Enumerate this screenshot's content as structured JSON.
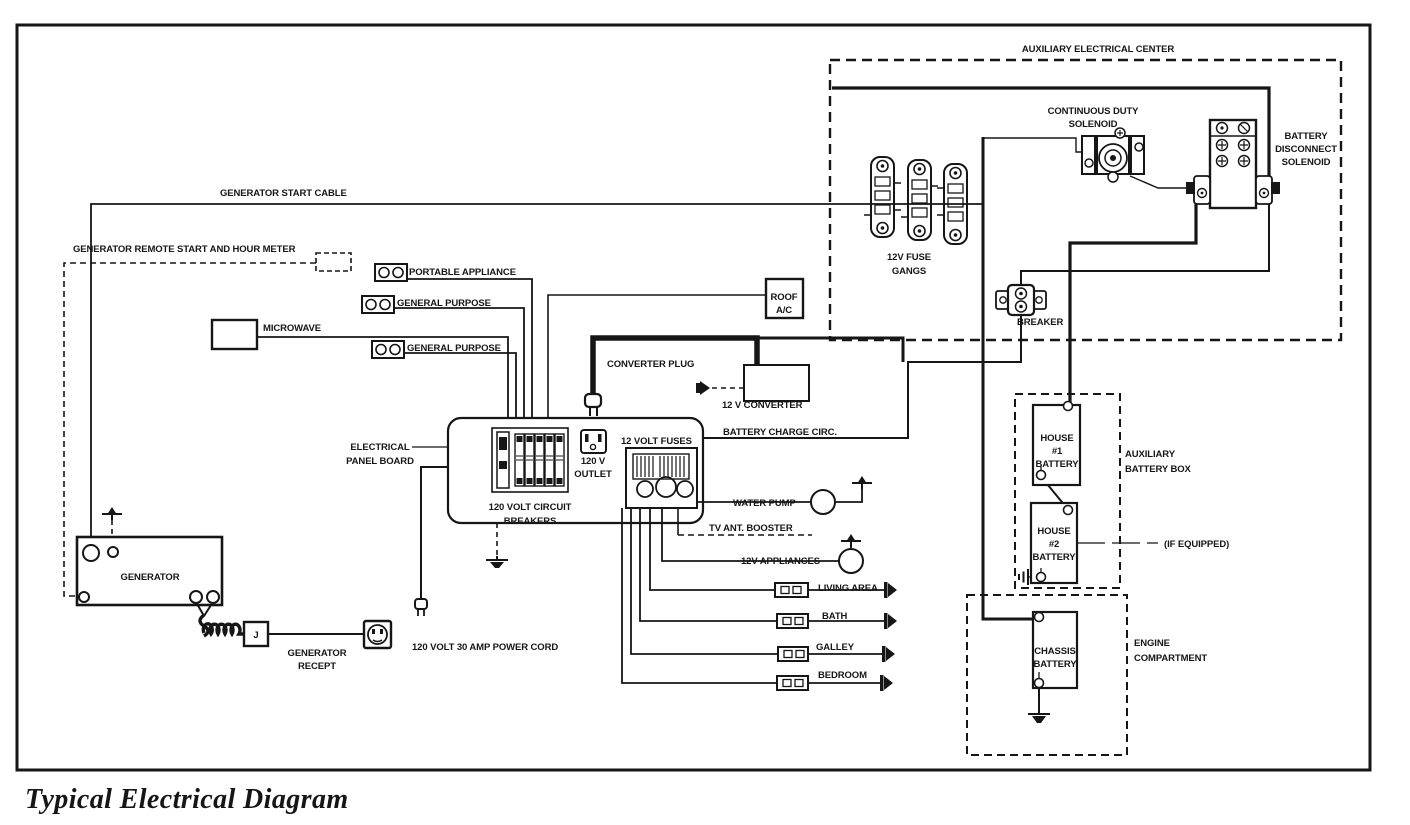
{
  "title": "Typical Electrical Diagram",
  "colors": {
    "ink": "#161616",
    "paper": "#ffffff"
  },
  "labels": {
    "aux_center": "AUXILIARY ELECTRICAL CENTER",
    "continuous_duty_1": "CONTINUOUS DUTY",
    "continuous_duty_2": "SOLENOID",
    "battery_disconnect_1": "BATTERY",
    "battery_disconnect_2": "DISCONNECT",
    "battery_disconnect_3": "SOLENOID",
    "fuse_gangs_1": "12V FUSE",
    "fuse_gangs_2": "GANGS",
    "breaker": "BREAKER",
    "generator_start_cable": "GENERATOR START CABLE",
    "generator_remote": "GENERATOR REMOTE START AND HOUR METER",
    "portable_appliance": "PORTABLE APPLIANCE",
    "general_purpose_1": "GENERAL PURPOSE",
    "microwave": "MICROWAVE",
    "general_purpose_2": "GENERAL PURPOSE",
    "roof_ac_1": "ROOF",
    "roof_ac_2": "A/C",
    "converter_plug": "CONVERTER PLUG",
    "twelve_v_converter": "12 V CONVERTER",
    "electrical_panel_1": "ELECTRICAL",
    "electrical_panel_2": "PANEL BOARD",
    "outlet_120v_1": "120 V",
    "outlet_120v_2": "OUTLET",
    "twelve_volt_fuses": "12 VOLT FUSES",
    "battery_charge": "BATTERY CHARGE CIRC.",
    "circuit_breakers_1": "120 VOLT CIRCUIT",
    "circuit_breakers_2": "BREAKERS",
    "water_pump": "WATER PUMP",
    "tv_ant_booster": "TV ANT. BOOSTER",
    "twelve_v_appliances": "12V APPLIANCES",
    "living_area": "LIVING AREA",
    "bath": "BATH",
    "galley": "GALLEY",
    "bedroom": "BEDROOM",
    "generator": "GENERATOR",
    "generator_recept_1": "GENERATOR",
    "generator_recept_2": "RECEPT",
    "j_box": "J",
    "power_cord": "120 VOLT 30 AMP POWER CORD",
    "house1_1": "HOUSE",
    "house1_2": "#1",
    "house1_3": "BATTERY",
    "aux_battery_box_1": "AUXILIARY",
    "aux_battery_box_2": "BATTERY BOX",
    "house2_1": "HOUSE",
    "house2_2": "#2",
    "house2_3": "BATTERY",
    "if_equipped": "(IF EQUIPPED)",
    "chassis_1": "CHASSIS",
    "chassis_2": "BATTERY",
    "engine_1": "ENGINE",
    "engine_2": "COMPARTMENT"
  }
}
